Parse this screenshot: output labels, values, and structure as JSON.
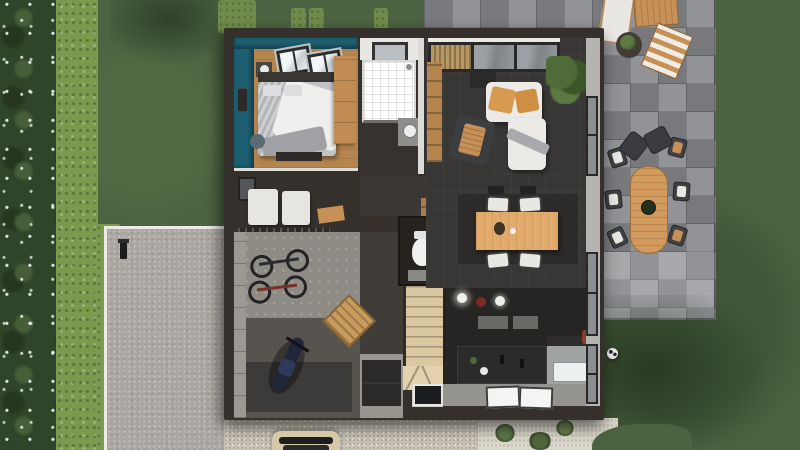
{
  "scene": {
    "kind": "3d-floor-plan-top-view",
    "setting": "single-family house with garden, hedge, driveway and stone paver patio",
    "visible_text": ""
  },
  "colors": {
    "grass": "#4c6341",
    "grass-light": "#6f8c4c",
    "tree": "#2f4428",
    "hedge": "#7a9a4e",
    "wall": "#35302b",
    "floor-dark": "#393735",
    "floor-wood": "#b5854f",
    "teal": "#1d5f70",
    "concrete": "#aaa7a1",
    "paver": "#84878b",
    "stair-wood": "#dcc8a0",
    "wood-furniture": "#d29a5d",
    "sofa": "#eceae6",
    "cushion": "#d89a4f",
    "gravel": "#c9c3b6",
    "white-gravel": "#dcd8cd",
    "appliance-white": "#e6e5e2",
    "kitchen-dark": "#262524",
    "counter-gray": "#a2a4a3",
    "garage-light": "#8e8b85",
    "garage-dark": "#57544f"
  },
  "house": {
    "rooms": [
      {
        "name": "bedroom",
        "features": [
          "teal accent walls",
          "wood floor"
        ],
        "furniture": [
          "double-bed",
          "headboard",
          "pillows",
          "wardrobe",
          "nightstand",
          "table-lamp",
          "foot-bench",
          "pouf",
          "wall-art",
          "two-skylight-windows"
        ]
      },
      {
        "name": "bathroom",
        "furniture": [
          "walk-in-tiled-shower",
          "vanity-sink",
          "window"
        ]
      },
      {
        "name": "laundry-room",
        "furniture": [
          "washing-machine",
          "tumble-dryer",
          "wood-shelf",
          "small-window"
        ]
      },
      {
        "name": "garage",
        "features": [
          "two-tone concrete floor"
        ],
        "furniture": [
          "two-wall-mounted-bicycles",
          "motorcycle",
          "wooden-pallet",
          "metal-shelving-rack",
          "floor-mat"
        ]
      },
      {
        "name": "living-room",
        "furniture": [
          "corner-sofa",
          "two-tan-seat-cushions",
          "gray-throw",
          "lounge-chair-with-wood-seat",
          "dark-side-table",
          "tall-sideboard",
          "hall-console",
          "houseplant",
          "north-window-band",
          "louvered-shutter"
        ]
      },
      {
        "name": "dining-area",
        "furniture": [
          "wooden-dining-table",
          "four-white-seat-chairs",
          "two-chair-backs",
          "dark-area-rug",
          "table-decor",
          "cup"
        ]
      },
      {
        "name": "kitchen",
        "furniture": [
          "dark-cabinet-row",
          "kitchen-island",
          "two-sink-faucets",
          "white-bowl",
          "herb-pot",
          "three-pendant-lights",
          "gray-countertop",
          "refrigerator-front",
          "two-glass-floor-panels",
          "red-item-by-window"
        ]
      },
      {
        "name": "wc",
        "furniture": [
          "toilet",
          "wall-shelf",
          "floor-mat"
        ]
      },
      {
        "name": "staircase",
        "furniture": [
          "straight-wooden-run",
          "winder-steps",
          "dark-doormat"
        ]
      },
      {
        "name": "entry-hall",
        "furniture": [
          "large-doormat",
          "glass-floor-panel"
        ]
      }
    ],
    "right-wall-windows": 3
  },
  "outdoor": {
    "areas": [
      "lawn",
      "flowering-tree-strip",
      "tall-hedge",
      "shrub-patches",
      "stone-paver-patio",
      "lighter-paver-section",
      "concrete-driveway-with-white-edge",
      "driveway-hedge-row",
      "gravel-path",
      "white-gravel-planting-bed",
      "curved-lawn-edge",
      "tree-shadows"
    ],
    "objects": [
      "oval-outdoor-dining-table",
      "planter-on-table",
      "six-outdoor-chairs",
      "two-dark-lounge-chairs",
      "bbq-corner-white-table",
      "bbq-corner-wood-bench",
      "bbq-corner-wood-chair",
      "round-planter-pot",
      "garden-lamp",
      "soccer-ball",
      "parked-car"
    ]
  },
  "counts": {
    "skylights": 2,
    "bicycles": 2,
    "pendant-lights": 3,
    "dining-chairs": 4,
    "outdoor-chairs": 6,
    "lounge-chairs": 2,
    "washer-dryer-units": 2
  }
}
